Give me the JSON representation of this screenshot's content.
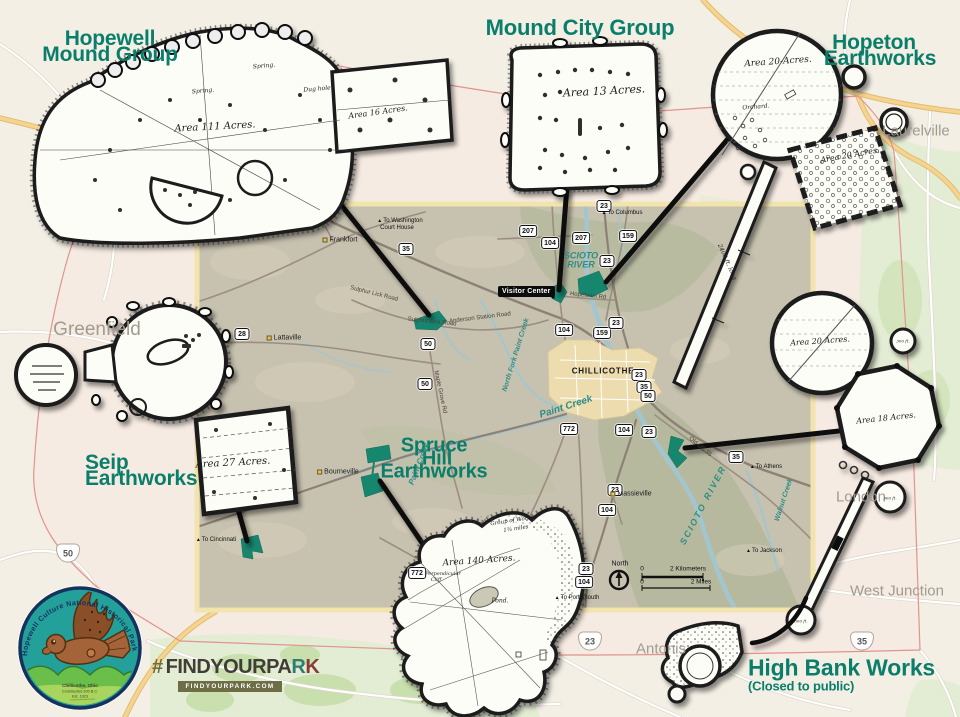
{
  "titles": {
    "hopewell": [
      "Hopewell",
      "Mound Group"
    ],
    "mound_city": "Mound City Group",
    "hopeton": [
      "Hopeton",
      "Earthworks"
    ],
    "seip": [
      "Seip",
      "Earthworks"
    ],
    "spruce_hill": [
      "Spruce",
      "Hill",
      "Earthworks"
    ],
    "high_bank": "High Bank Works",
    "high_bank_note": "(Closed to public)"
  },
  "drawings": {
    "labels": [
      {
        "text": "Area 111 Acres.",
        "x": 215,
        "y": 127,
        "rot": -3,
        "size": 10
      },
      {
        "text": "Area 16 Acres.",
        "x": 378,
        "y": 112,
        "rot": -8,
        "size": 8
      },
      {
        "text": "Spring.",
        "x": 264,
        "y": 66,
        "rot": -5,
        "size": 6
      },
      {
        "text": "Spring.",
        "x": 203,
        "y": 91,
        "rot": -5,
        "size": 6
      },
      {
        "text": "Dug hole.",
        "x": 318,
        "y": 89,
        "rot": -5,
        "size": 6
      },
      {
        "text": "Area 13 Acres.",
        "x": 604,
        "y": 91,
        "rot": -3,
        "size": 11
      },
      {
        "text": "Area 20-Acres.",
        "x": 778,
        "y": 62,
        "rot": -4,
        "size": 9
      },
      {
        "text": "Orchard.",
        "x": 756,
        "y": 107,
        "rot": -4,
        "size": 6
      },
      {
        "text": "Area 20 Acres.",
        "x": 850,
        "y": 155,
        "rot": -10,
        "size": 8
      },
      {
        "text": "2400 ft. long",
        "x": 727,
        "y": 262,
        "rot": 66,
        "size": 6
      },
      {
        "text": "Area 27 Acres.",
        "x": 233,
        "y": 463,
        "rot": -3,
        "size": 10
      },
      {
        "text": "Area 140 Acres.",
        "x": 479,
        "y": 561,
        "rot": -4,
        "size": 9
      },
      {
        "text": "Pond.",
        "x": 500,
        "y": 601,
        "rot": 0,
        "size": 6
      },
      {
        "text": "Group of Works",
        "x": 512,
        "y": 521,
        "rot": -9,
        "size": 5.5
      },
      {
        "text": "1¾ miles",
        "x": 516,
        "y": 529,
        "rot": -9,
        "size": 5.5
      },
      {
        "text": "Perpendicular",
        "x": 443,
        "y": 574,
        "rot": 0,
        "size": 5
      },
      {
        "text": "Cliff",
        "x": 436,
        "y": 580,
        "rot": 0,
        "size": 5
      },
      {
        "text": "Area 20 Acres.",
        "x": 820,
        "y": 341,
        "rot": -4,
        "size": 8
      },
      {
        "text": "Area 18 Acres.",
        "x": 886,
        "y": 418,
        "rot": -6,
        "size": 8
      },
      {
        "text": "300 ft.",
        "x": 903,
        "y": 341,
        "rot": 0,
        "size": 4
      },
      {
        "text": "300 ft.",
        "x": 890,
        "y": 498,
        "rot": 0,
        "size": 4
      },
      {
        "text": "300 ft.",
        "x": 801,
        "y": 621,
        "rot": 0,
        "size": 4
      }
    ]
  },
  "inset": {
    "visitor_center": "Visitor Center",
    "chillicothe": "CHILLICOTHE",
    "north_label": "North",
    "scale": {
      "zero_km": "0",
      "km": "2 Kilometers",
      "zero_mi": "0",
      "mi": "2 Miles"
    },
    "shields": [
      {
        "label": "23",
        "x": 604,
        "y": 206
      },
      {
        "label": "207",
        "x": 528,
        "y": 231
      },
      {
        "label": "104",
        "x": 550,
        "y": 243
      },
      {
        "label": "207",
        "x": 581,
        "y": 238
      },
      {
        "label": "159",
        "x": 628,
        "y": 236
      },
      {
        "label": "23",
        "x": 607,
        "y": 261
      },
      {
        "label": "35",
        "x": 406,
        "y": 249
      },
      {
        "label": "28",
        "x": 242,
        "y": 334
      },
      {
        "label": "50",
        "x": 428,
        "y": 344
      },
      {
        "label": "50",
        "x": 425,
        "y": 384
      },
      {
        "label": "104",
        "x": 564,
        "y": 330
      },
      {
        "label": "159",
        "x": 602,
        "y": 333
      },
      {
        "label": "23",
        "x": 616,
        "y": 323
      },
      {
        "label": "23",
        "x": 639,
        "y": 375
      },
      {
        "label": "35",
        "x": 644,
        "y": 387
      },
      {
        "label": "50",
        "x": 648,
        "y": 396
      },
      {
        "label": "772",
        "x": 569,
        "y": 429
      },
      {
        "label": "104",
        "x": 624,
        "y": 430
      },
      {
        "label": "23",
        "x": 649,
        "y": 432
      },
      {
        "label": "35",
        "x": 736,
        "y": 457
      },
      {
        "label": "772",
        "x": 417,
        "y": 573
      },
      {
        "label": "23",
        "x": 615,
        "y": 490
      },
      {
        "label": "104",
        "x": 607,
        "y": 510
      },
      {
        "label": "23",
        "x": 586,
        "y": 569
      },
      {
        "label": "104",
        "x": 584,
        "y": 582
      }
    ],
    "towns": [
      {
        "name": "Frankfort",
        "x": 340,
        "y": 240
      },
      {
        "name": "Lattaville",
        "x": 284,
        "y": 338
      },
      {
        "name": "Bourneville",
        "x": 338,
        "y": 472
      },
      {
        "name": "Massieville",
        "x": 631,
        "y": 494
      }
    ],
    "waterways": [
      {
        "name": "SCIOTO RIVER",
        "x": 581,
        "y": 261,
        "rot": 0,
        "size": 9,
        "wrap": true,
        "w": 40
      },
      {
        "name": "SCIOTO RIVER",
        "x": 703,
        "y": 505,
        "rot": -62,
        "size": 9,
        "ls": 2
      },
      {
        "name": "Paint Creek",
        "x": 566,
        "y": 407,
        "rot": -18,
        "size": 10
      },
      {
        "name": "Paint Creek",
        "x": 419,
        "y": 464,
        "rot": -68,
        "size": 8
      },
      {
        "name": "North Fork Paint Creek",
        "x": 516,
        "y": 355,
        "rot": -73,
        "size": 7
      },
      {
        "name": "Walnut Creek",
        "x": 784,
        "y": 500,
        "rot": -72,
        "size": 7
      }
    ],
    "road_labels": [
      {
        "name": "Sulphur Lick Road",
        "x": 374,
        "y": 294,
        "rot": 14
      },
      {
        "name": "Sulphur Lick Road",
        "x": 432,
        "y": 322,
        "rot": 6
      },
      {
        "name": "Anderson Station Road",
        "x": 480,
        "y": 318,
        "rot": -7
      },
      {
        "name": "Maple Grove Rd",
        "x": 440,
        "y": 392,
        "rot": 78
      },
      {
        "name": "Hopetown Rd",
        "x": 588,
        "y": 296,
        "rot": 6
      },
      {
        "name": "Old US 35",
        "x": 700,
        "y": 447,
        "rot": 40
      }
    ],
    "directions": [
      {
        "label": "To Washington",
        "x": 400,
        "y": 221,
        "arrow": true
      },
      {
        "label": "Court House",
        "x": 397,
        "y": 228,
        "arrow": false
      },
      {
        "label": "To Columbus",
        "x": 622,
        "y": 213,
        "arrow": true
      },
      {
        "label": "To Cincinnati",
        "x": 216,
        "y": 540,
        "arrow": true
      },
      {
        "label": "To Athens",
        "x": 766,
        "y": 467,
        "arrow": true
      },
      {
        "label": "To Jackson",
        "x": 764,
        "y": 551,
        "arrow": true
      },
      {
        "label": "To Portsmouth",
        "x": 577,
        "y": 598,
        "arrow": true
      }
    ]
  },
  "outside": {
    "towns": [
      {
        "name": "Greenfield",
        "x": 97,
        "y": 330,
        "size": 19
      },
      {
        "name": "Laurelville",
        "x": 916,
        "y": 131,
        "size": 15
      },
      {
        "name": "London",
        "x": 861,
        "y": 497,
        "size": 15
      },
      {
        "name": "West Junction",
        "x": 897,
        "y": 591,
        "size": 15
      },
      {
        "name": "Antonis",
        "x": 661,
        "y": 649,
        "size": 15
      }
    ],
    "us_shields": [
      {
        "label": "50",
        "x": 68,
        "y": 553
      },
      {
        "label": "23",
        "x": 590,
        "y": 641
      },
      {
        "label": "35",
        "x": 862,
        "y": 641
      }
    ]
  },
  "branding": {
    "logo_arc": "Hopewell Culture National Historical Park",
    "logo_line1": "Chillicothe, Ohio",
    "logo_line2": "Constructed 200 B.C.",
    "logo_line3": "Est. 1923",
    "hash": "#",
    "main": "FINDYOURPA",
    "r": "R",
    "k": "K",
    "url": "FINDYOURPARK.COM"
  }
}
